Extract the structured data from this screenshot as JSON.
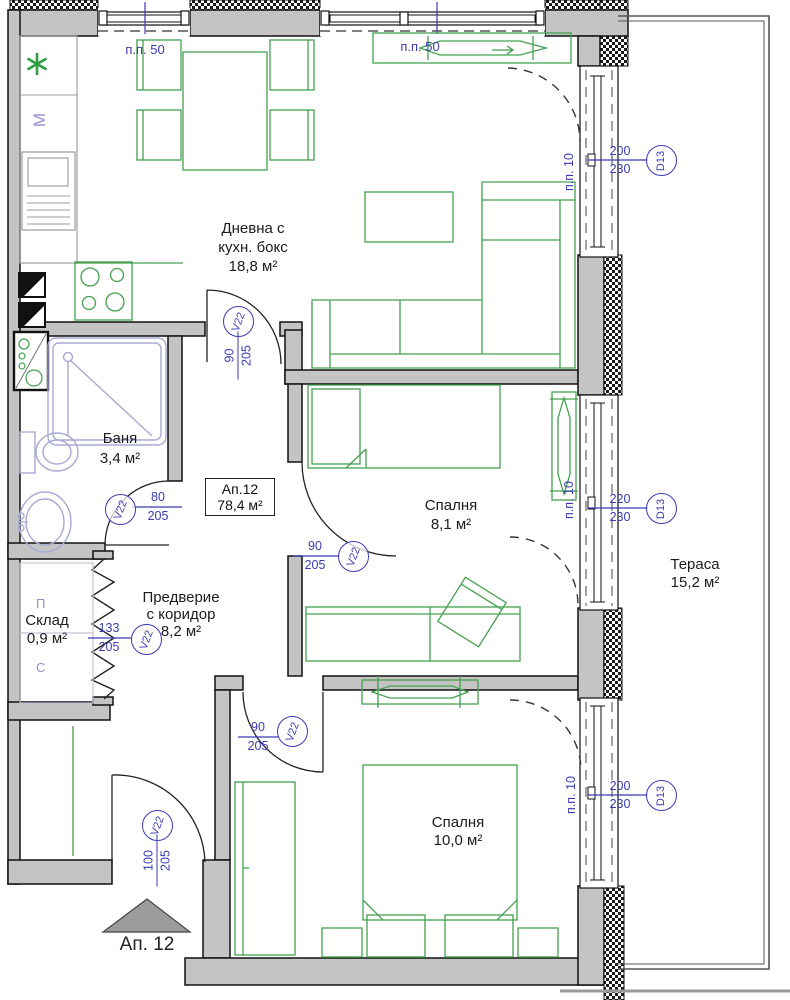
{
  "rooms": {
    "living": {
      "name_line1": "Дневна с",
      "name_line2": "кухн. бокс",
      "area": "18,8 м²"
    },
    "bath": {
      "name": "Баня",
      "area": "3,4 м²"
    },
    "bedroom1": {
      "name": "Спалня",
      "area": "8,1 м²"
    },
    "bedroom2": {
      "name": "Спалня",
      "area": "10,0 м²"
    },
    "storage": {
      "name": "Склад",
      "area": "0,9 м²"
    },
    "hallway": {
      "name_line1": "Предверие",
      "name_line2": "с коридор",
      "area": "8,2 м²"
    },
    "terrace": {
      "name": "Тераса",
      "area": "15,2 м²"
    }
  },
  "apartment_box": {
    "line1": "Ап.12",
    "line2": "78,4 м²"
  },
  "entrance": {
    "label": "Ап. 12"
  },
  "windows": [
    {
      "label": "п.п. 50"
    },
    {
      "label": "п.п. 50"
    }
  ],
  "wall_panels": [
    {
      "label": "п.п. 10"
    },
    {
      "label": "п.п. 10"
    },
    {
      "label": "п.п. 10"
    }
  ],
  "doors": {
    "hall_living": {
      "tag": "V22",
      "width": "90",
      "height": "205"
    },
    "bath": {
      "tag": "V22",
      "width": "80",
      "height": "205"
    },
    "bedroom1": {
      "tag": "V22",
      "width": "90",
      "height": "205"
    },
    "storage": {
      "tag": "V22",
      "width": "133",
      "height": "205"
    },
    "bedroom2": {
      "tag": "V22",
      "width": "90",
      "height": "205"
    },
    "entrance": {
      "tag": "V22",
      "width": "100",
      "height": "205"
    },
    "terrace_living": {
      "tag": "D13",
      "width": "200",
      "height": "230"
    },
    "terrace_bedroom1": {
      "tag": "D13",
      "width": "220",
      "height": "230"
    },
    "terrace_bedroom2": {
      "tag": "D13",
      "width": "200",
      "height": "230"
    }
  },
  "marks": {
    "kitchen_m": "М",
    "storage_washer": "П",
    "storage_dryer": "С"
  },
  "colors": {
    "wall": "#c4c4c4",
    "furniture_green": "#44a04e",
    "annotation_blue": "#3b3bb4",
    "fixture_purple": "#a8aad6",
    "hatch": "#1a1a1a"
  }
}
